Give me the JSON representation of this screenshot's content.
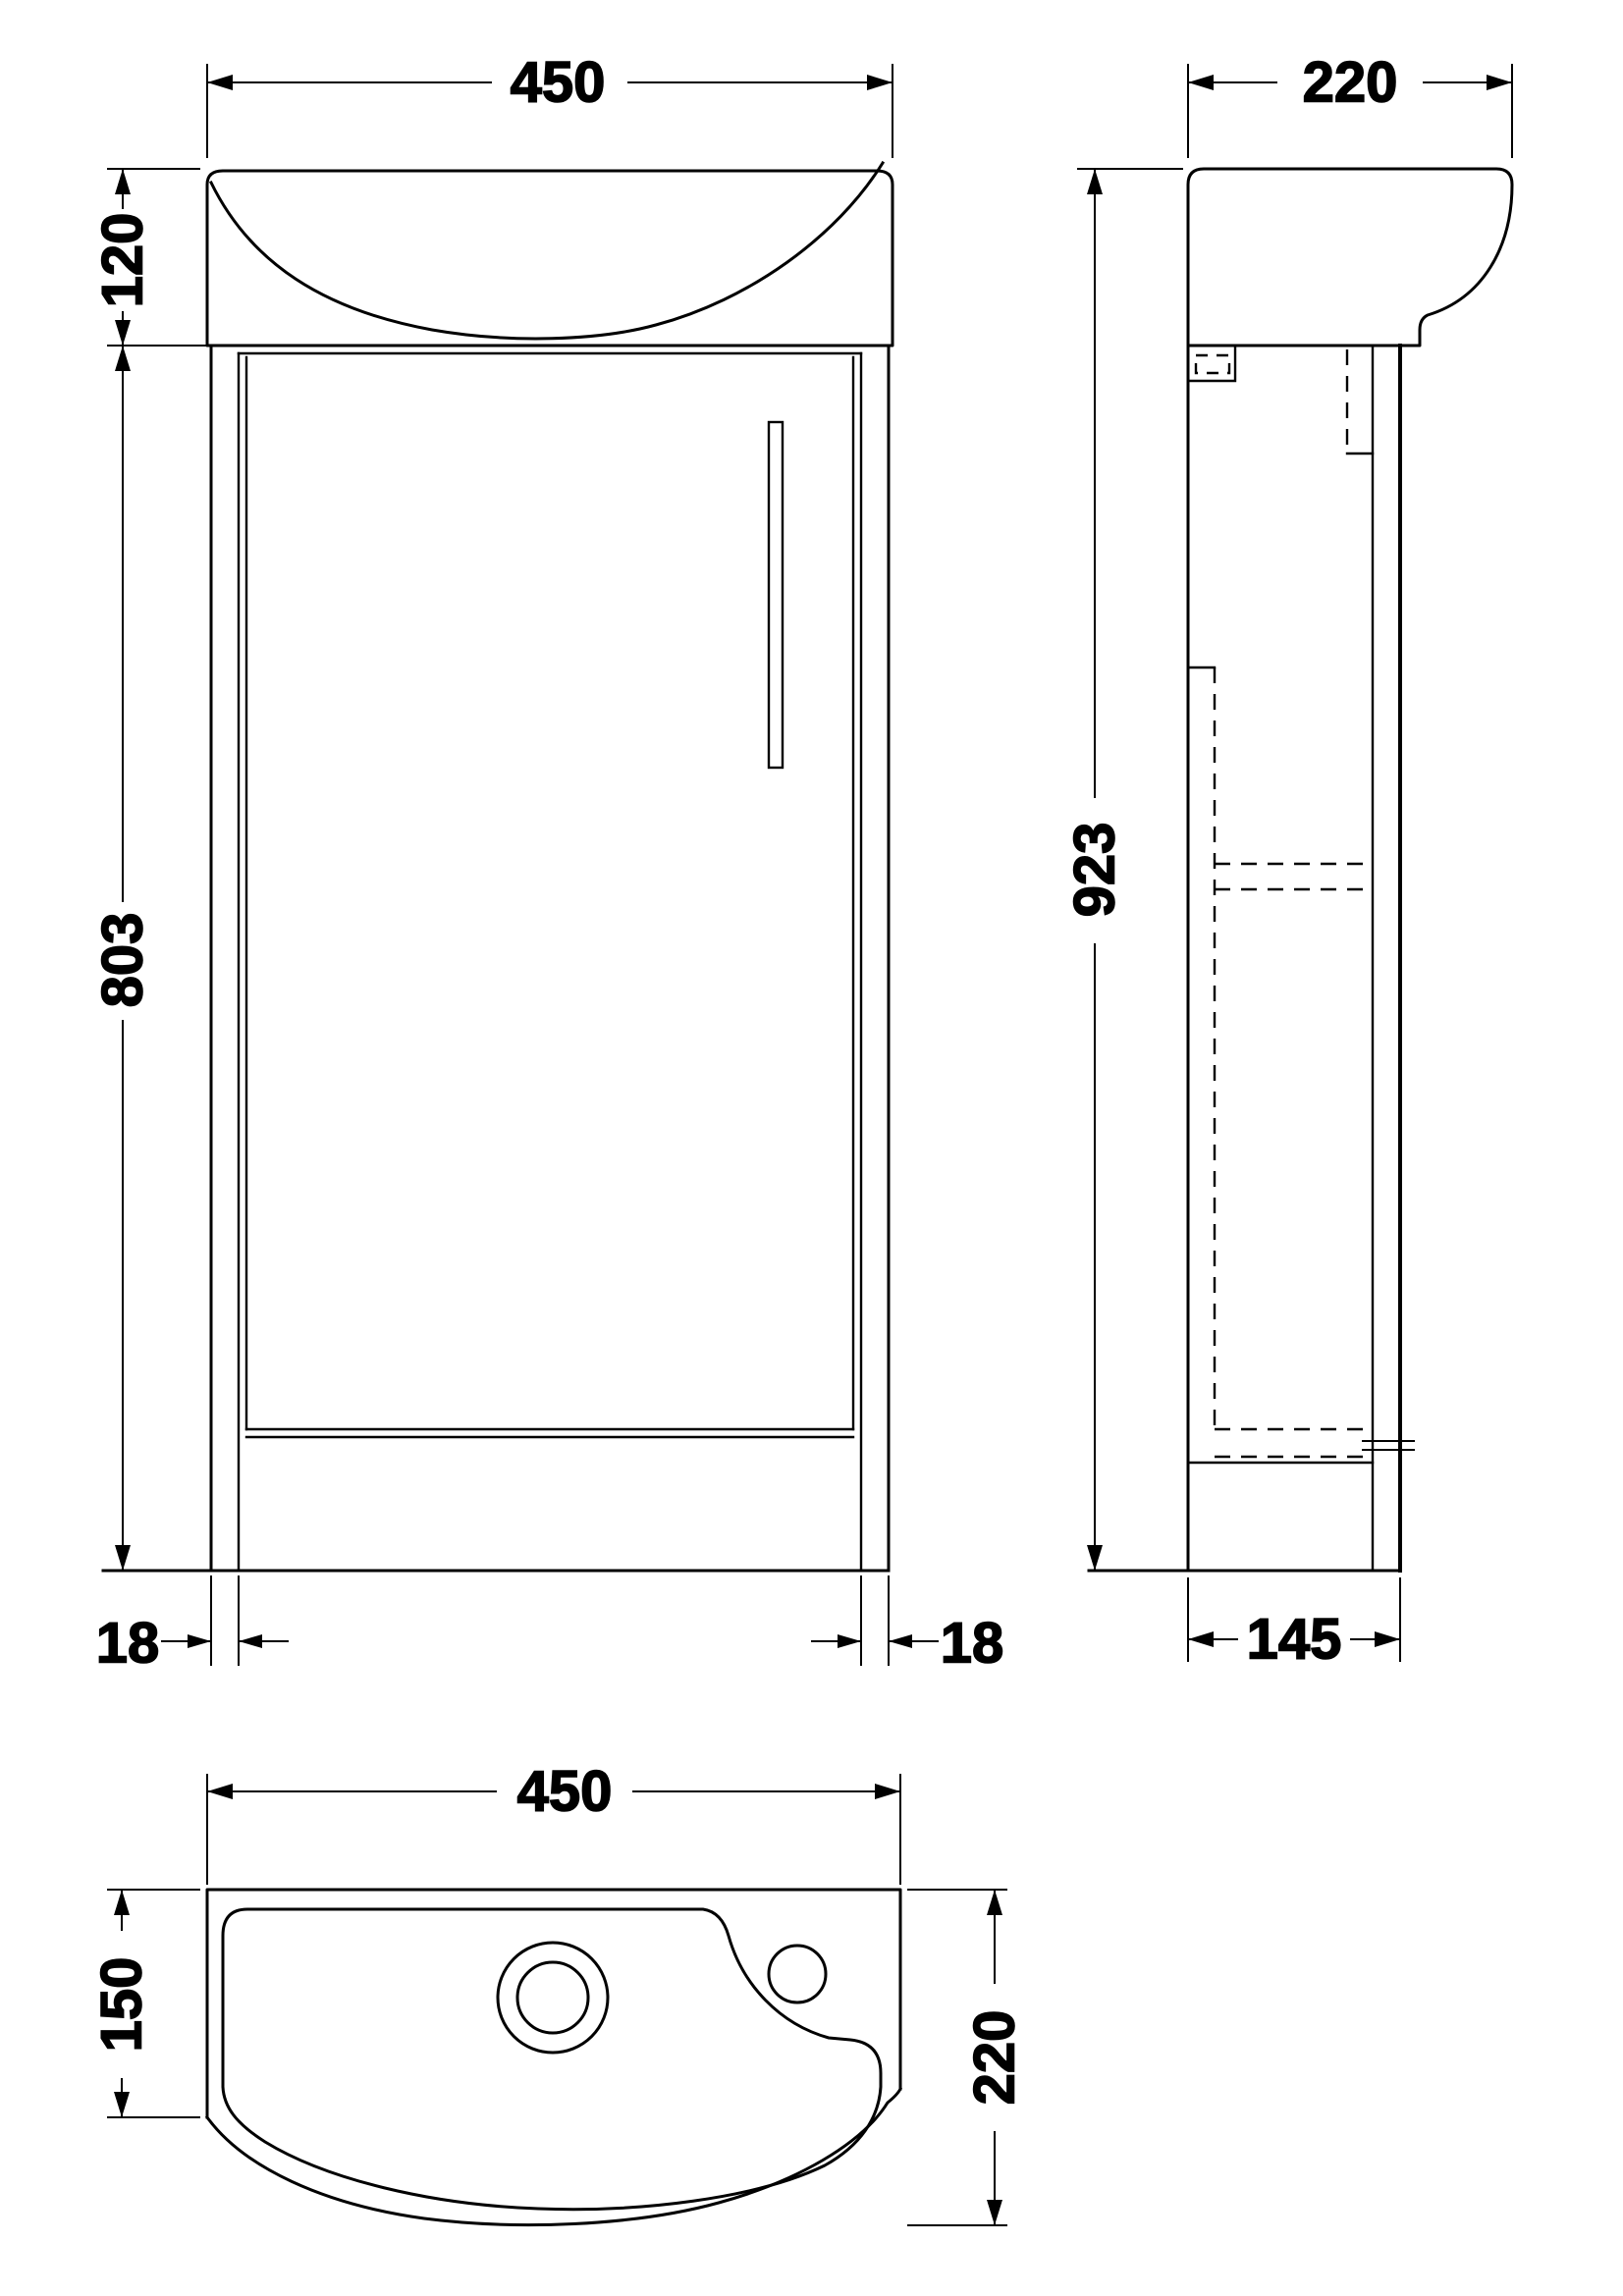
{
  "drawing": {
    "type": "technical-orthographic-drawing",
    "subject": "bathroom vanity basin unit",
    "line_color": "#000000",
    "background_color": "#ffffff",
    "views": {
      "front": {
        "label": "front-elevation",
        "dims": {
          "overall_width": "450",
          "basin_height": "120",
          "cabinet_height": "803",
          "left_panel_thickness": "18",
          "right_panel_thickness": "18"
        }
      },
      "side": {
        "label": "side-elevation",
        "dims": {
          "basin_depth": "220",
          "overall_height": "923",
          "cabinet_base_depth": "145"
        }
      },
      "plan": {
        "label": "plan-view",
        "dims": {
          "overall_width": "450",
          "left_edge_depth": "150",
          "overall_depth": "220"
        }
      }
    }
  }
}
